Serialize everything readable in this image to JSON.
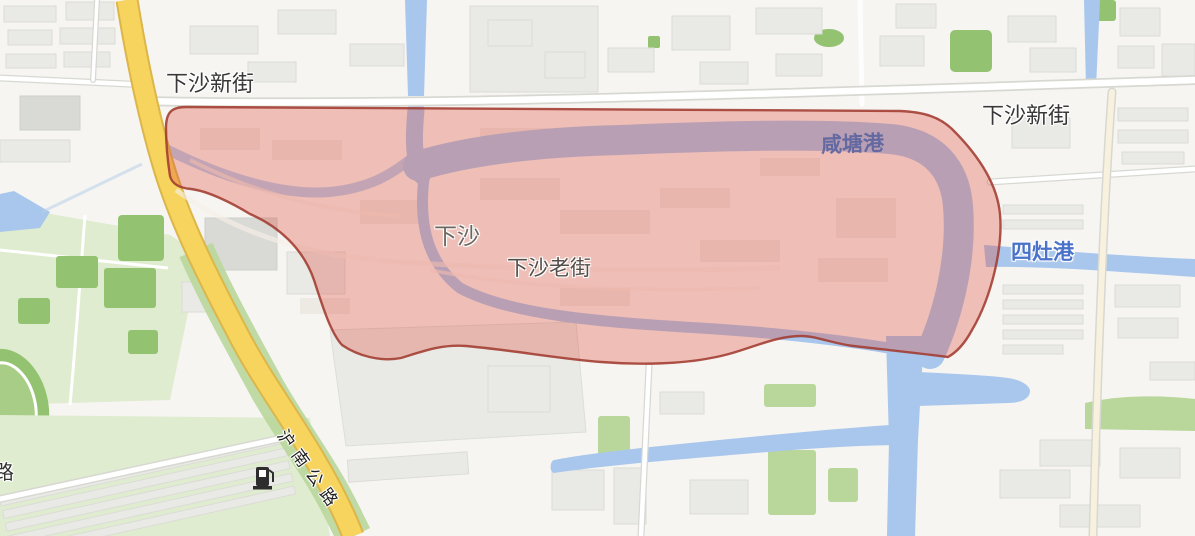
{
  "labels": {
    "road_top_left": "下沙新街",
    "road_top_right": "下沙新街",
    "river_top": "咸塘港",
    "river_east": "四灶港",
    "town": "下沙",
    "old_street": "下沙老街",
    "highway": "沪南公路",
    "road_partial_left": "路"
  },
  "colors": {
    "highlight_fill": "#dc4a3c",
    "highlight_border": "#a23b30",
    "water": "#a9c7ec",
    "road_yellow": "#f6d45e",
    "road_yellow_casing": "#dcb64b",
    "green": "#b9d79b",
    "green_dark": "#93c371",
    "green_pale": "#dfeccf",
    "label_blue": "#4a72c8"
  }
}
